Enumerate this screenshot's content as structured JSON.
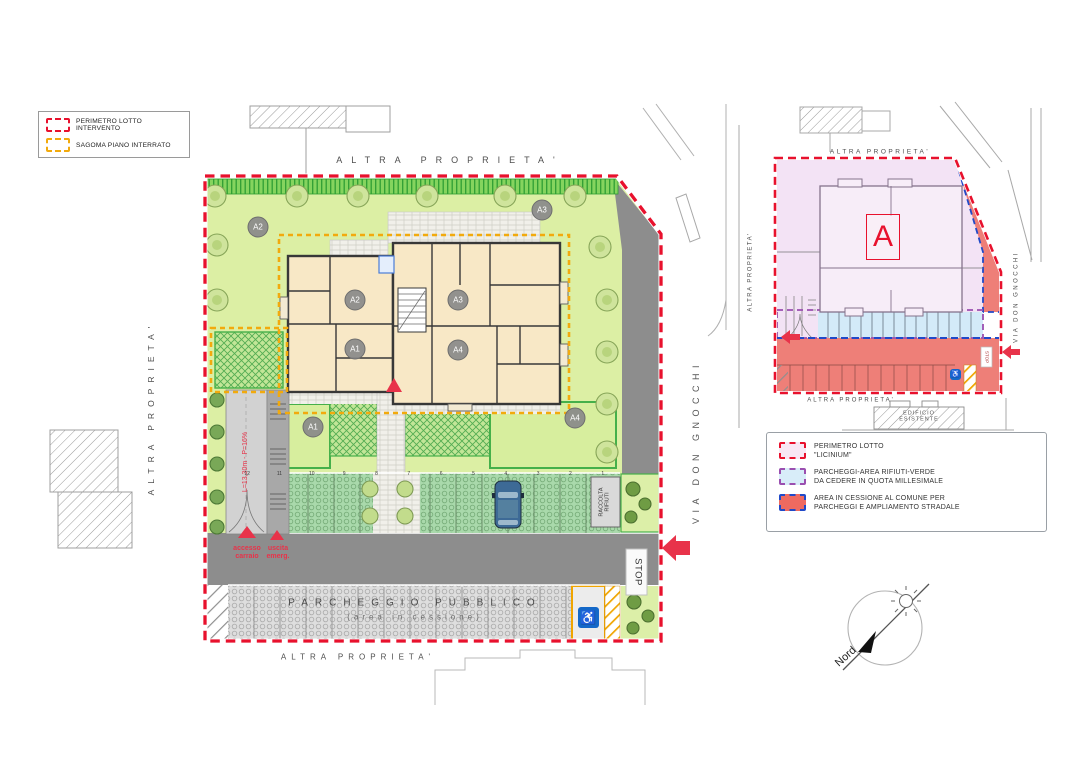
{
  "legend_main": {
    "items": [
      {
        "label": "PERIMETRO LOTTO INTERVENTO"
      },
      {
        "label": "SAGOMA PIANO INTERRATO"
      }
    ]
  },
  "main_plan": {
    "altra_top": "ALTRA PROPRIETA'",
    "altra_left": "ALTRA PROPRIETA'",
    "altra_bottom": "ALTRA PROPRIETA'",
    "street_name": "VIA DON GNOCCHI",
    "stop_sign": "STOP",
    "parking_title": "PARCHEGGIO PUBBLICO",
    "parking_subtitle": "(area in cessione)",
    "ramp_label": "L=13,30m - P=16%",
    "access_label": "accesso\ncarraio",
    "emergency_exit_label": "uscita\nemerg.",
    "waste_label": "RACCOLTA\nRIFIUTI",
    "building_units": {
      "a1": "A1",
      "a2": "A2",
      "a3": "A3",
      "a4": "A4"
    },
    "garden_units": {
      "a1": "A1",
      "a2": "A2",
      "a3": "A3",
      "a4": "A4"
    },
    "parking_numbers": [
      "12",
      "11",
      "10",
      "9",
      "8",
      "7",
      "6",
      "5",
      "4",
      "3",
      "2",
      "1"
    ]
  },
  "detail_plan": {
    "altra_top": "ALTRA PROPRIETA'",
    "altra_left": "ALTRA PROPRIETA'",
    "altra_bottom": "ALTRA PROPRIETA'",
    "street_name": "VIA DON GNOCCHI",
    "building_label": "A",
    "stop_sign": "STOP",
    "existing_building": "EDIFICIO\nESISTENTE",
    "legend": {
      "items": [
        {
          "line1": "PERIMETRO LOTTO",
          "line2": "\"LICINIUM\""
        },
        {
          "line1": "PARCHEGGI-AREA RIFIUTI-VERDE",
          "line2": "DA CEDERE IN QUOTA MILLESIMALE"
        },
        {
          "line1": "AREA IN CESSIONE AL COMUNE PER",
          "line2": "PARCHEGGI E AMPLIAMENTO STRADALE"
        }
      ]
    }
  },
  "compass": {
    "north_label": "Nord"
  },
  "icons": {
    "wheelchair": "♿"
  },
  "colors": {
    "perimeter_red": "#e8112d",
    "basement_yellow": "#f2aa0d",
    "millesimale_purple": "#9a4fb0",
    "cession_blue": "#2049c8",
    "cession_fill": "#ee7f78",
    "lot_pink": "#f3e3f5",
    "lawn_green": "#dcefa4",
    "road_gray": "#8d8d8d"
  }
}
